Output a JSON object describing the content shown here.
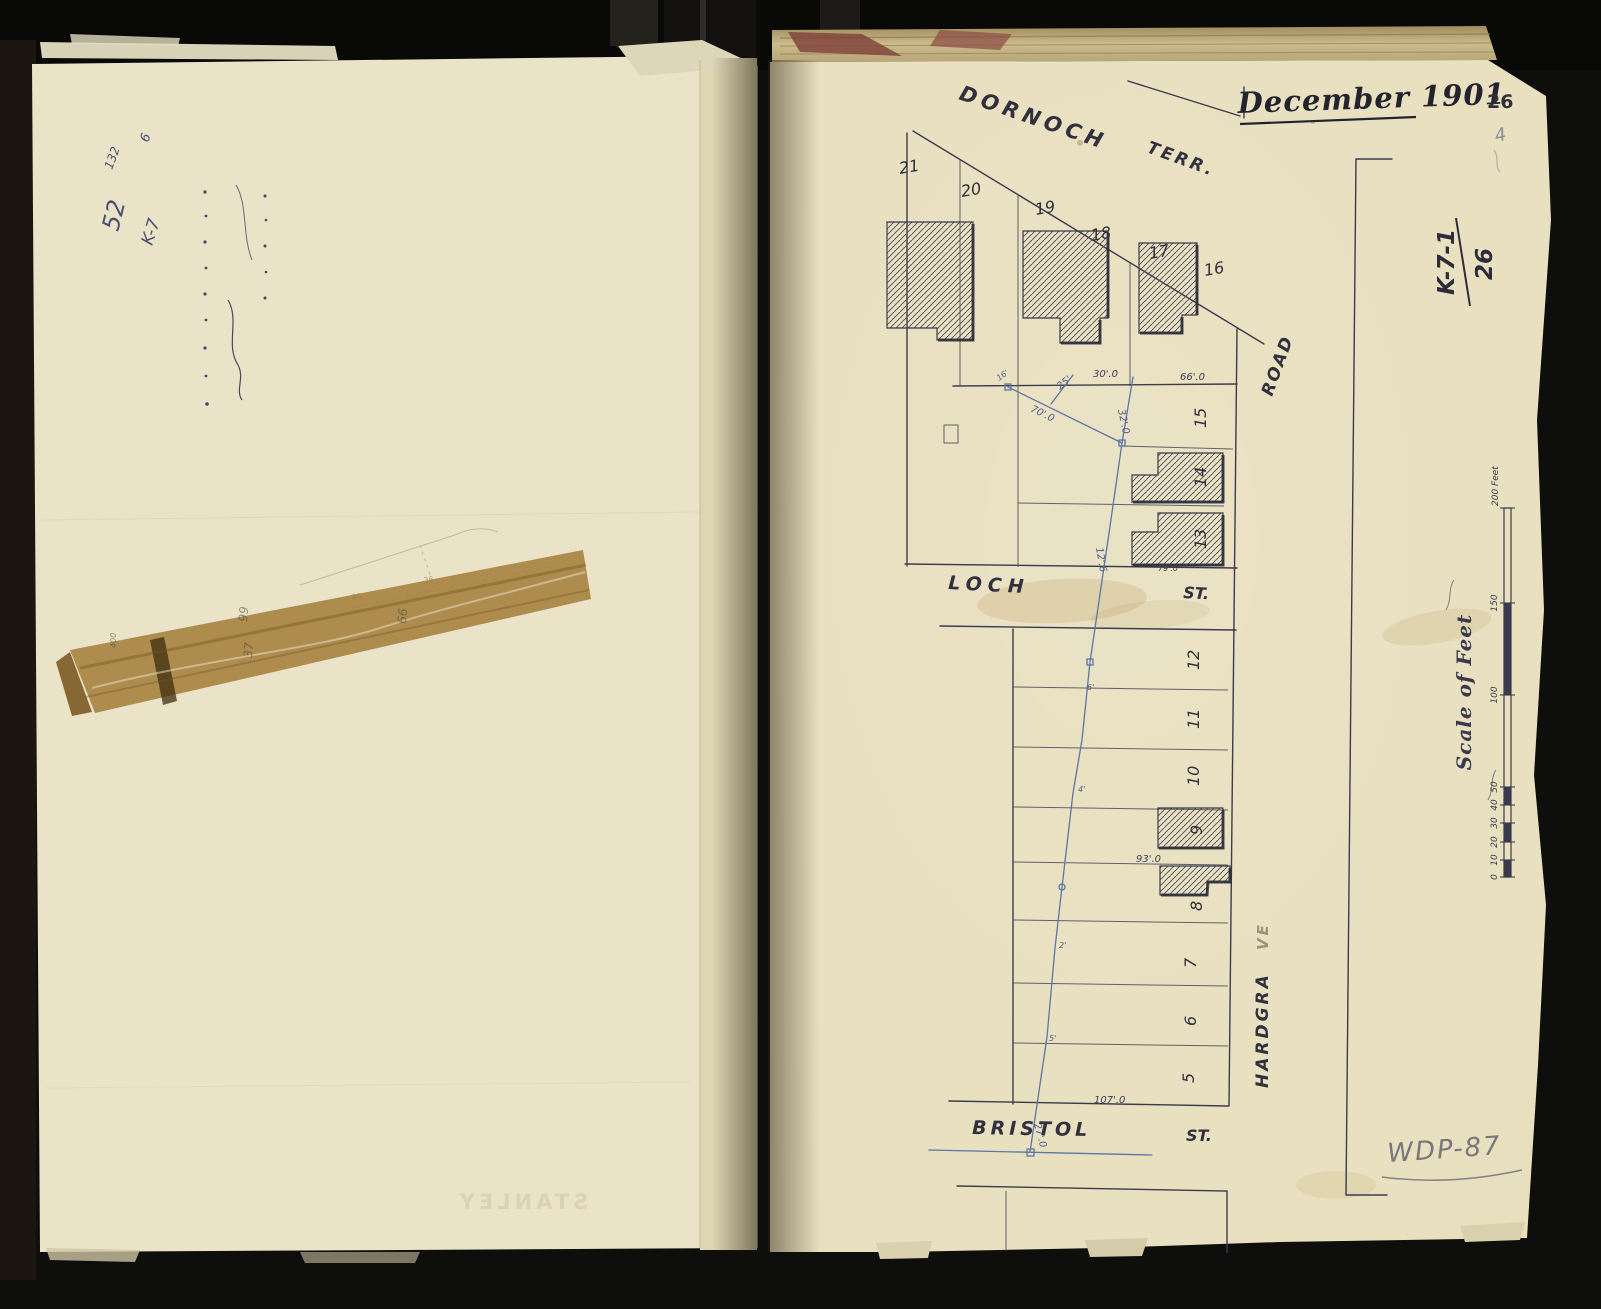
{
  "left_page": {
    "notes": {
      "n132": "132",
      "n52": "52",
      "k7": "K-7",
      "n6": "6"
    },
    "tape_numbers": {
      "a": "400",
      "b": "99",
      "c": "37",
      "d": "66"
    },
    "sketch_numbers": {
      "a": "30",
      "b": "36"
    },
    "bleedthrough": "STANLEY"
  },
  "right_page": {
    "date_title": "December 1901",
    "page_number": "26",
    "corner_pencil": "4",
    "ref_code": "K-7-1",
    "ref_page": "26",
    "footnote_pencil": "WDP-87",
    "streets": {
      "dornoch": "DORNOCH",
      "dornoch_suffix": "TERR.",
      "loch": "LOCH",
      "loch_suffix": "ST.",
      "bristol": "BRISTOL",
      "bristol_suffix": "ST.",
      "hardgrave_ink": "HARDGRA",
      "hardgrave_pencil": "VE",
      "road": "ROAD"
    },
    "lots": [
      "21",
      "20",
      "19",
      "18",
      "17",
      "16",
      "15",
      "14",
      "13",
      "12",
      "11",
      "10",
      "9",
      "8",
      "7",
      "6",
      "5"
    ],
    "measurements": [
      "30'.0",
      "66'.0",
      "70'.0",
      "25'",
      "32'.0",
      "12'.6",
      "79'.0",
      "93'.0",
      "107'.0",
      "27'.0",
      "16'",
      "6'",
      "4'",
      "2'",
      "5'"
    ],
    "scale_bar": {
      "title": "Scale of Feet",
      "top_label": "200 Feet",
      "ticks": [
        "150",
        "100",
        "50",
        "40",
        "30",
        "20",
        "10",
        "0"
      ]
    }
  }
}
